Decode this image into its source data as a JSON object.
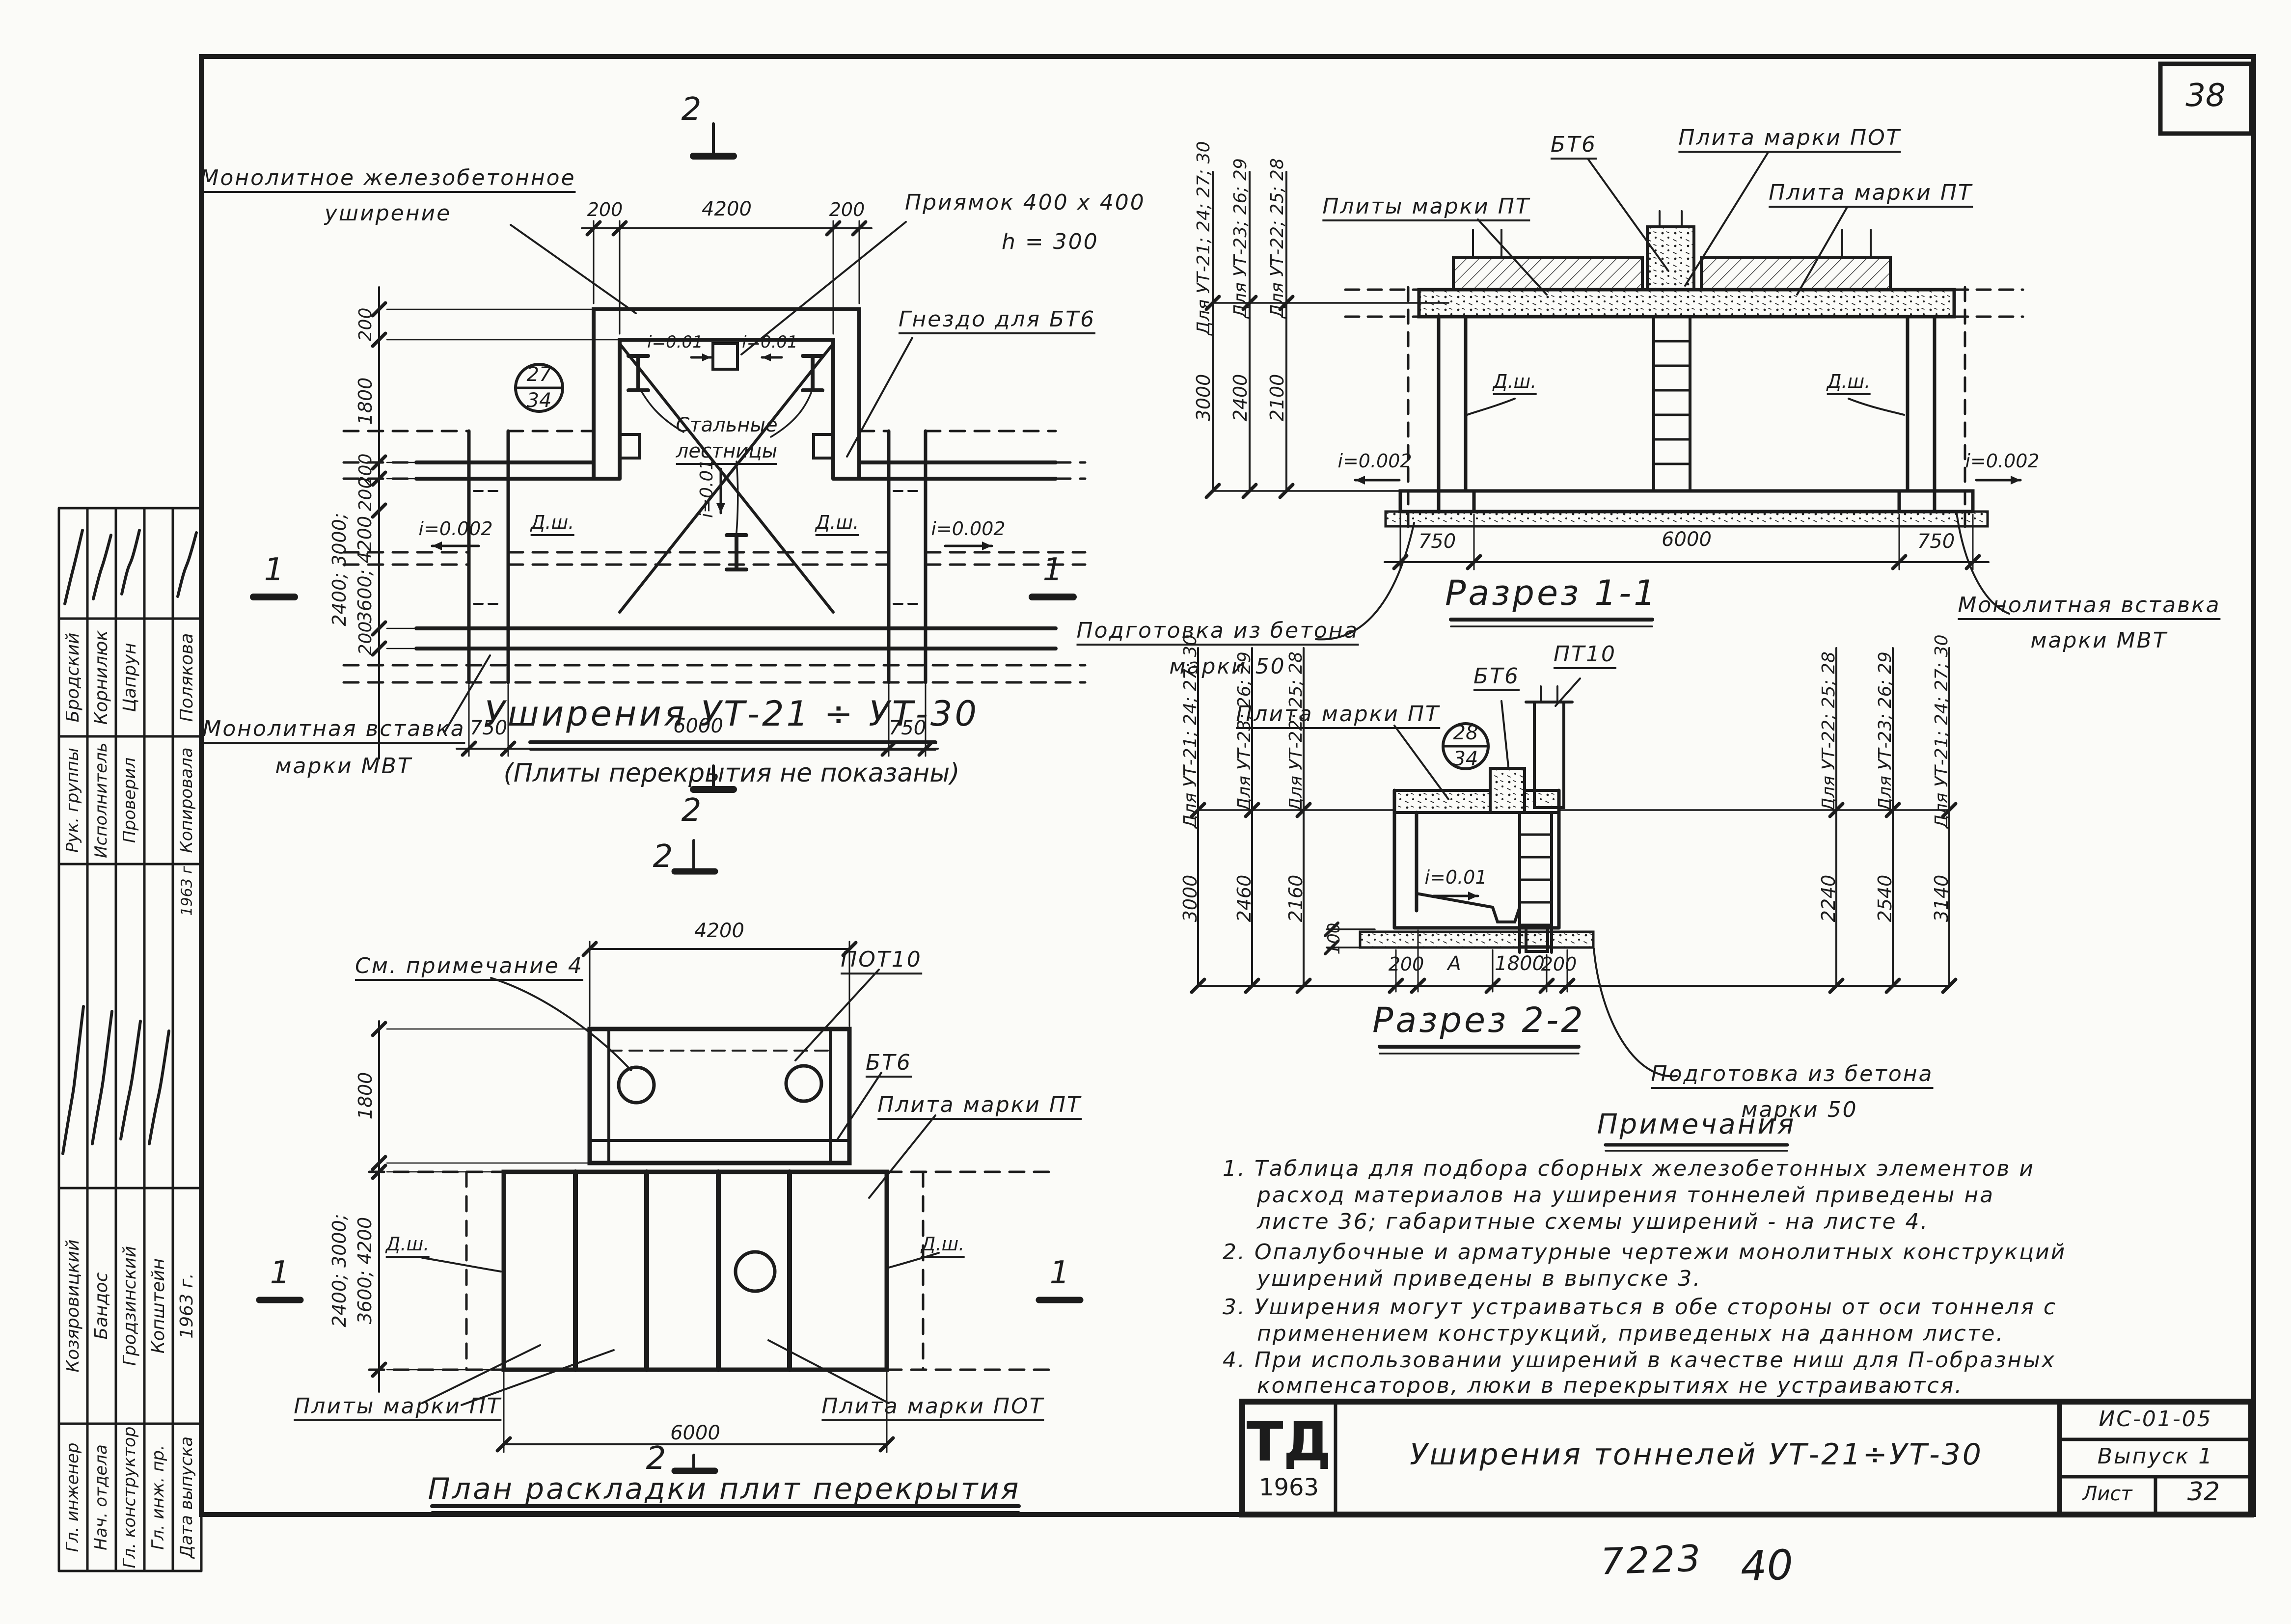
{
  "sheet": {
    "page_number": "38",
    "doc_code_bottom": "7223",
    "sheet_code_bottom": "40"
  },
  "plan": {
    "label_widening_1": "Монолитное железобетонное",
    "label_widening_2": "уширение",
    "label_pit_1": "Приямок 400 х 400",
    "label_pit_2": "h = 300",
    "label_socket": "Гнездо для БТ6",
    "label_ladders_1": "Стальные",
    "label_ladders_2": "лестницы",
    "label_insert_1": "Монолитная вставка",
    "label_insert_2": "марки МВТ",
    "slope_left": "i=0.002",
    "slope_right": "i=0.002",
    "slope_center": "i=0.01",
    "slope_pit_left": "i=0.01",
    "slope_pit_right": "i=0.01",
    "joint_left": "Д.ш.",
    "joint_right": "Д.ш.",
    "detail_circle_top": "27",
    "detail_circle_bottom": "34",
    "dim_top_left": "200",
    "dim_top_mid": "4200",
    "dim_top_right": "200",
    "dim_left_wall_top": "200",
    "dim_left_interior": "1800",
    "dim_left_wall2": "200",
    "dim_left_wall3": "200",
    "dim_left_tunnel_1": "2400; 3000;",
    "dim_left_tunnel_2": "3600; 4200",
    "dim_left_bottom": "200",
    "dim_bottom_left": "750",
    "dim_bottom_mid": "6000",
    "dim_bottom_right": "750",
    "mark_top": "2",
    "mark_bottom": "2",
    "mark_left": "1",
    "mark_right": "1",
    "title": "Уширения УТ-21 ÷ УТ-30",
    "subtitle": "(Плиты перекрытия не показаны)"
  },
  "slab_plan": {
    "label_note": "См. примечание 4",
    "label_pot10": "ПОТ10",
    "label_bt6": "БТ6",
    "label_pt_right": "Плита марки ПТ",
    "label_pt_bottom": "Плиты марки ПТ",
    "label_pot_bottom": "Плита марки ПОТ",
    "joint_left": "Д.ш.",
    "joint_right": "Д.ш.",
    "dim_top": "4200",
    "dim_left_top": "1800",
    "dim_left_1": "2400; 3000;",
    "dim_left_2": "3600; 4200",
    "dim_bottom": "6000",
    "mark_top": "2",
    "mark_bottom": "2",
    "mark_left": "1",
    "mark_right": "1",
    "title": "План раскладки плит перекрытия"
  },
  "section11": {
    "title": "Разрез 1-1",
    "label_pt_plural": "Плиты марки ПТ",
    "label_bt6": "БТ6",
    "label_pot": "Плита марки ПОТ",
    "label_pt": "Плита марки ПТ",
    "joint_left": "Д.ш.",
    "joint_right": "Д.ш.",
    "slope_left": "i=0.002",
    "slope_right": "i=0.002",
    "label_prep_1": "Подготовка из бетона",
    "label_prep_2": "марки 50",
    "label_insert_1": "Монолитная вставка",
    "label_insert_2": "марки МВТ",
    "grid_label_1": "Для УТ-21; 24; 27; 30",
    "grid_label_2": "Для УТ-23; 26; 29",
    "grid_label_3": "Для УТ-22; 25; 28",
    "grid_dim_1": "3000",
    "grid_dim_2": "2400",
    "grid_dim_3": "2100",
    "dim_bottom_left": "750",
    "dim_bottom_mid": "6000",
    "dim_bottom_right": "750"
  },
  "section22": {
    "title": "Разрез 2-2",
    "label_pt": "Плита марки ПТ",
    "label_bt6": "БТ6",
    "label_pt10": "ПТ10",
    "detail_circle_top": "28",
    "detail_circle_bottom": "34",
    "slope": "i=0.01",
    "label_prep_1": "Подготовка из бетона",
    "label_prep_2": "марки 50",
    "grid_left_label_1": "Для УТ-21; 24; 27; 30",
    "grid_left_label_2": "Для УТ-23; 26; 29",
    "grid_left_label_3": "Для УТ-22; 25; 28",
    "grid_left_dim_1": "3000",
    "grid_left_dim_2": "2460",
    "grid_left_dim_3": "2160",
    "grid_right_label_1": "Для УТ-22; 25; 28",
    "grid_right_label_2": "Для УТ-23; 26; 29",
    "grid_right_label_3": "Для УТ-21; 24; 27; 30",
    "grid_right_dim_1": "2240",
    "grid_right_dim_2": "2540",
    "grid_right_dim_3": "3140",
    "dim_small_left": "100",
    "dim_bottom_1": "200",
    "dim_bottom_2": "А",
    "dim_bottom_3": "1800",
    "dim_bottom_4": "200"
  },
  "notes": {
    "title": "Примечания",
    "n1_l1": "1. Таблица для подбора сборных железобетонных элементов и",
    "n1_l2": "расход материалов на уширения тоннелей приведены на",
    "n1_l3": "листе 36; габаритные схемы уширений - на листе 4.",
    "n2_l1": "2. Опалубочные и арматурные чертежи монолитных конструкций",
    "n2_l2": "уширений приведены в выпуске 3.",
    "n3_l1": "3. Уширения могут устраиваться в обе стороны от оси тоннеля с",
    "n3_l2": "применением конструкций, приведеных на данном листе.",
    "n4_l1": "4. При использовании уширений в качестве ниш для П-образных",
    "n4_l2": "компенсаторов, люки в перекрытиях не устраиваются."
  },
  "title_block": {
    "logo_top": "ТД",
    "logo_year": "1963",
    "title": "Уширения тоннелей УТ-21÷УТ-30",
    "code": "ИС-01-05",
    "issue": "Выпуск 1",
    "sheet_label": "Лист",
    "sheet_number": "32"
  },
  "stamp": {
    "rows_top": [
      {
        "role": "Рук. группы",
        "name": "Бродский"
      },
      {
        "role": "Исполнитель",
        "name": "Корнилюк"
      },
      {
        "role": "Проверил",
        "name": "Цапрун"
      },
      {
        "role": "",
        "name": ""
      },
      {
        "role": "Копировала",
        "name": "Полякова"
      }
    ],
    "date_top": "1963 г.",
    "rows_bottom": [
      {
        "role": "Гл. инженер",
        "name": "Козяровицкий"
      },
      {
        "role": "Нач. отдела",
        "name": "Бандос"
      },
      {
        "role": "Гл. конструктор",
        "name": "Гродзинский"
      },
      {
        "role": "Гл. инж. пр.",
        "name": "Копштейн"
      },
      {
        "role": "Дата выпуска",
        "name": "1963 г."
      }
    ]
  }
}
